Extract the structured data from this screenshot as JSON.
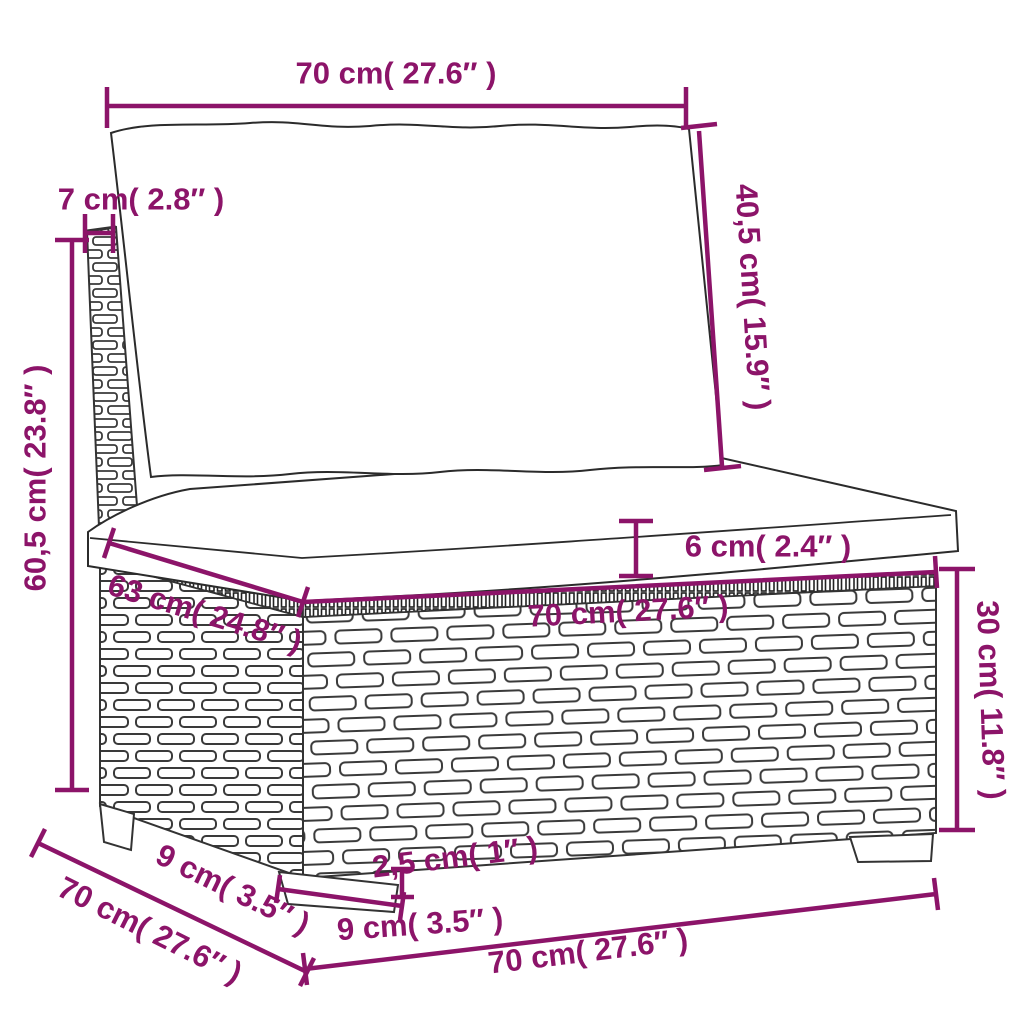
{
  "colors": {
    "accent": "#8C1469",
    "line_art": "#333333",
    "background": "#FFFFFF"
  },
  "illustration": "line-art poly rattan sofa middle section with back cushion, seat cushion, woven base and legs",
  "dimensions": {
    "top_width": "70 cm( 27.6″ )",
    "back_cushion_height": "40,5 cm( 15.9″ )",
    "back_panel_thickness": "7 cm( 2.8″ )",
    "overall_height": "60,5 cm( 23.8″ )",
    "seat_cushion_thickness": "6 cm( 2.4″ )",
    "seat_depth": "63 cm( 24.8″ )",
    "seat_front_width": "70 cm( 27.6″ )",
    "base_height": "30 cm( 11.8″ )",
    "side_depth_upper": "9 cm( 3.5″ )",
    "side_depth": "70 cm( 27.6″ )",
    "front_leg_width": "9 cm( 3.5″ )",
    "leg_height": "2,5 cm( 1″ )",
    "bottom_front_width": "70 cm( 27.6″ )"
  }
}
